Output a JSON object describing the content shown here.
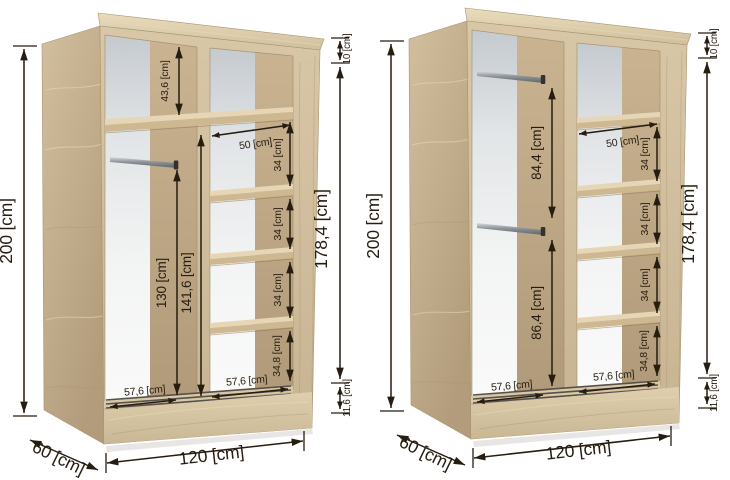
{
  "colors": {
    "background": "#ffffff",
    "ink": "#261c10",
    "wood_front": "#cfbd9d",
    "wood_side": "#c4ae8d",
    "wood_top": "#dccbab",
    "wood_inner_wall": "#bda886",
    "shelf_top": "#e6d6b5",
    "back_panel_top": "#c5cacf",
    "back_panel_bottom": "#fafafa",
    "rail_metal": "#9aa0a4",
    "door_track": "#57514a"
  },
  "wardrobe_left": {
    "dims": {
      "total_height": "200 [cm]",
      "top_gap": "10 [cm]",
      "interior_height": "178,4 [cm]",
      "base_height": "11,6 [cm]",
      "total_width": "120 [cm]",
      "depth": "60 [cm]",
      "upper_section": "43,6 [cm]",
      "rail_to_floor": "130 [cm]",
      "left_column_height": "141,6 [cm]",
      "shelf_depth": "50 [cm]",
      "shelf_sections": [
        "34 [cm]",
        "34 [cm]",
        "34 [cm]",
        "34,8 [cm]"
      ],
      "column_widths": [
        "57,6 [cm]",
        "57,6 [cm]"
      ]
    }
  },
  "wardrobe_right": {
    "dims": {
      "total_height": "200 [cm]",
      "top_gap": "10 [cm]",
      "interior_height": "178,4 [cm]",
      "base_height": "11,6 [cm]",
      "total_width": "120 [cm]",
      "depth": "60 [cm]",
      "upper_rail_section": "84,4 [cm]",
      "lower_rail_section": "86,4 [cm]",
      "shelf_depth": "50 [cm]",
      "shelf_sections": [
        "34 [cm]",
        "34 [cm]",
        "34 [cm]",
        "34,8 [cm]"
      ],
      "column_widths": [
        "57,6 [cm]",
        "57,6 [cm]"
      ]
    }
  }
}
